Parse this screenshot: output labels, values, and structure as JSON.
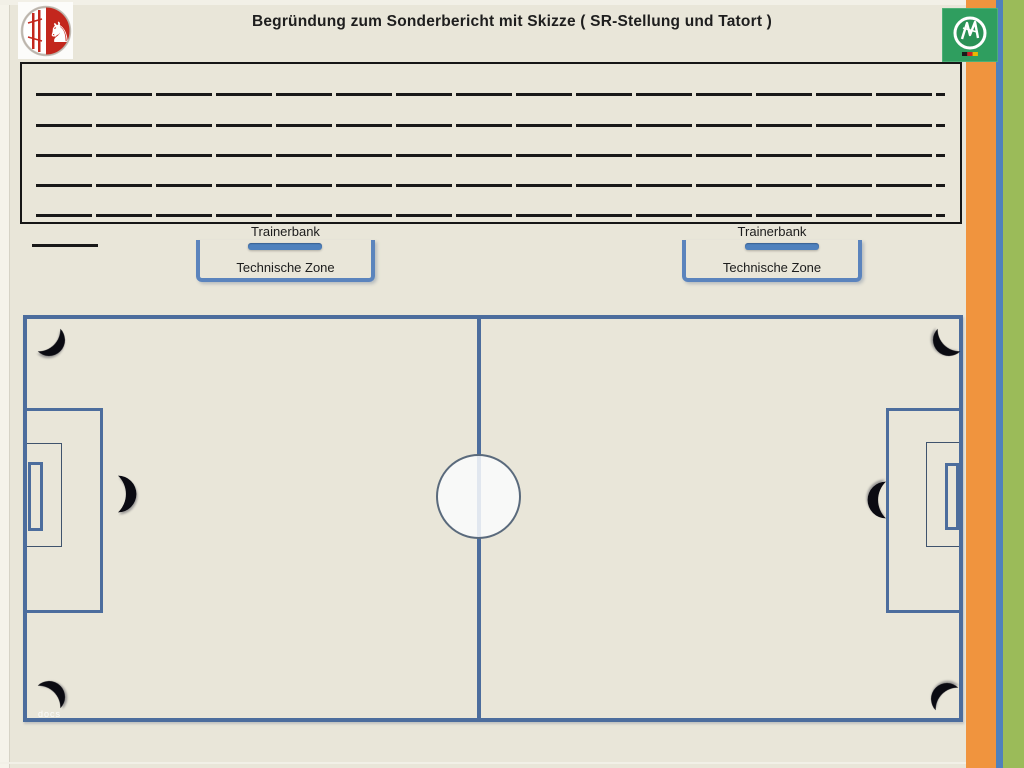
{
  "page": {
    "title": "Begründung zum Sonderbericht mit Skizze ( SR-Stellung und Tatort )",
    "watermark": "docs"
  },
  "logos": {
    "left": "flvw-westfalen-crest",
    "right": "dfb-logo"
  },
  "report_box": {
    "line_count": 5
  },
  "bench_zones": {
    "left": {
      "bench": "Trainerbank",
      "zone": "Technische Zone"
    },
    "right": {
      "bench": "Trainerbank",
      "zone": "Technische Zone"
    }
  },
  "colors": {
    "background": "#e9e6d9",
    "field_line_blue": "#4c6d9d",
    "accent_blue": "#4f81bd",
    "stripe_orange": "#f0943e",
    "stripe_blue": "#4f81bd",
    "stripe_green": "#9bbb59",
    "dfb_green": "#2f9e5f",
    "crest_red": "#c3271d",
    "arc_black": "#0b0b12"
  }
}
